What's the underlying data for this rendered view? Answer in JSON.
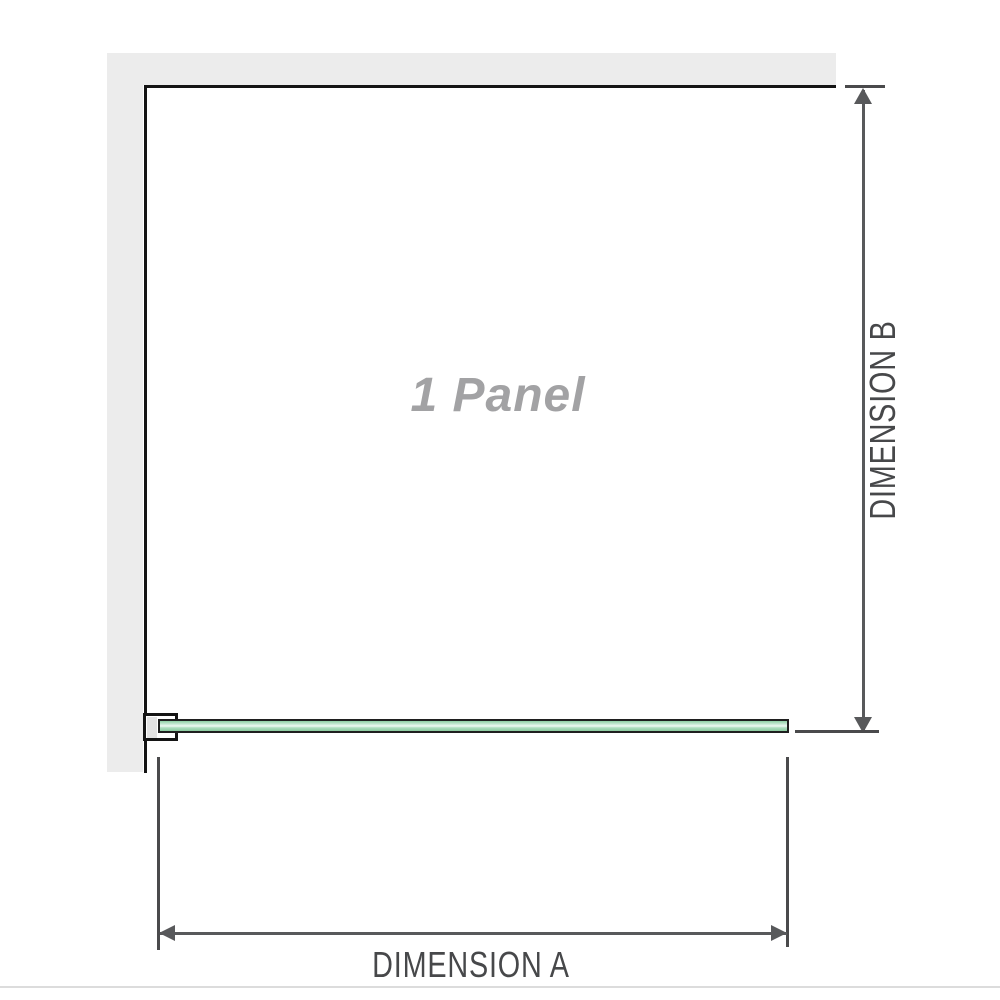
{
  "diagram": {
    "panel_label": "1 Panel",
    "dimension_a": {
      "label": "DIMENSION A"
    },
    "dimension_b": {
      "label": "DIMENSION B"
    },
    "colors": {
      "wall": "#ececec",
      "outline": "#141414",
      "dimension_line": "#58595b",
      "tick": "#4a4a4c",
      "label_text": "#47484a",
      "panel_label_text": "#a2a2a4",
      "glass_green": "#8ecfa4",
      "glass_green_light": "#eff9f3",
      "bracket_fill": "#ffffff",
      "bracket_inner": "#e3e3e3",
      "bottom_rule": "#dcdcdc"
    }
  }
}
